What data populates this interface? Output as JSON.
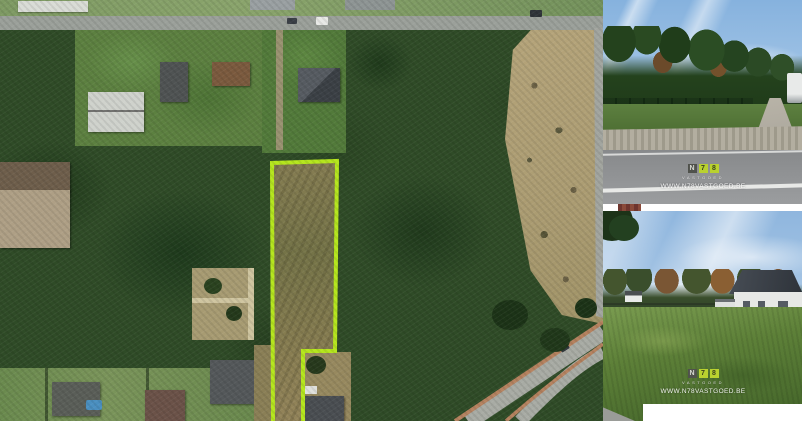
{
  "watermark": {
    "blocks": [
      {
        "char": "N"
      },
      {
        "char": "7"
      },
      {
        "char": "8"
      }
    ],
    "tagline": "VASTGOED",
    "url": "WWW.N78VASTGOED.BE",
    "brand_accent": "#b9d12f"
  },
  "map": {
    "parcel_outline_color": "#b5e61d"
  }
}
